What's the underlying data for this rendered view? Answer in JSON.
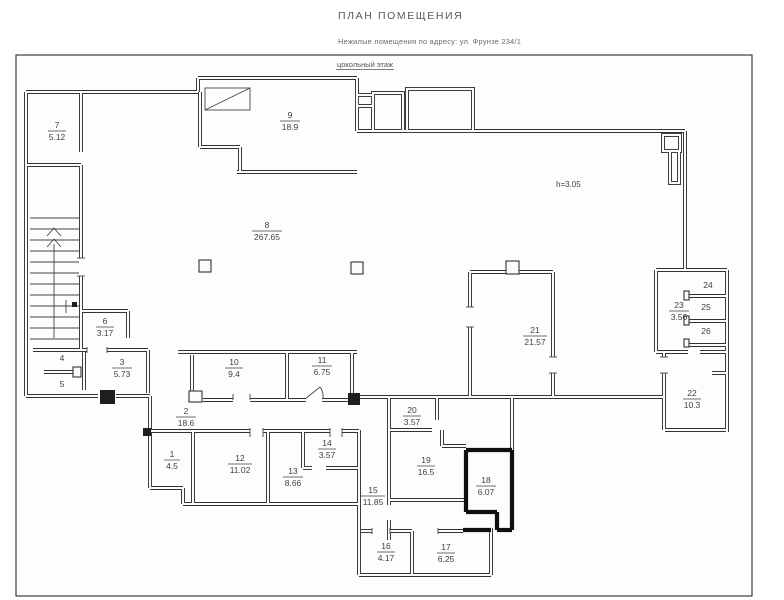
{
  "header": {
    "title": "ПЛАН ПОМЕЩЕНИЯ",
    "subtitle": "Нежилые помещения по адресу: ул. Фрунзе 234/1",
    "floor_label": "цокольный этаж"
  },
  "annotations": {
    "ceiling_height": "h=3.05"
  },
  "rooms": {
    "r1": {
      "number": "1",
      "area": "4.5"
    },
    "r2": {
      "number": "2",
      "area": "18.6"
    },
    "r3": {
      "number": "3",
      "area": "5.73"
    },
    "r4": {
      "number": "4"
    },
    "r5": {
      "number": "5"
    },
    "r6": {
      "number": "6",
      "area": "3.17"
    },
    "r7": {
      "number": "7",
      "area": "5.12"
    },
    "r8": {
      "number": "8",
      "area": "267.65"
    },
    "r9": {
      "number": "9",
      "area": "18.9"
    },
    "r10": {
      "number": "10",
      "area": "9.4"
    },
    "r11": {
      "number": "11",
      "area": "6.75"
    },
    "r12": {
      "number": "12",
      "area": "11.02"
    },
    "r13": {
      "number": "13",
      "area": "8.66"
    },
    "r14": {
      "number": "14",
      "area": "3.57"
    },
    "r15": {
      "number": "15",
      "area": "11.85"
    },
    "r16": {
      "number": "16",
      "area": "4.17"
    },
    "r17": {
      "number": "17",
      "area": "6.25"
    },
    "r18": {
      "number": "18",
      "area": "6.07"
    },
    "r19": {
      "number": "19",
      "area": "16.5"
    },
    "r20": {
      "number": "20",
      "area": "3.57"
    },
    "r21": {
      "number": "21",
      "area": "21.57"
    },
    "r22": {
      "number": "22",
      "area": "10.3"
    },
    "r23": {
      "number": "23",
      "area": "3.56"
    },
    "r24": {
      "number": "24"
    },
    "r25": {
      "number": "25"
    },
    "r26": {
      "number": "26"
    }
  },
  "colors": {
    "paper": "#fdfdfb",
    "wall_ink": "#333333",
    "text_ink": "#4a4a4a",
    "highlight_wall": "#0f0f0f"
  }
}
